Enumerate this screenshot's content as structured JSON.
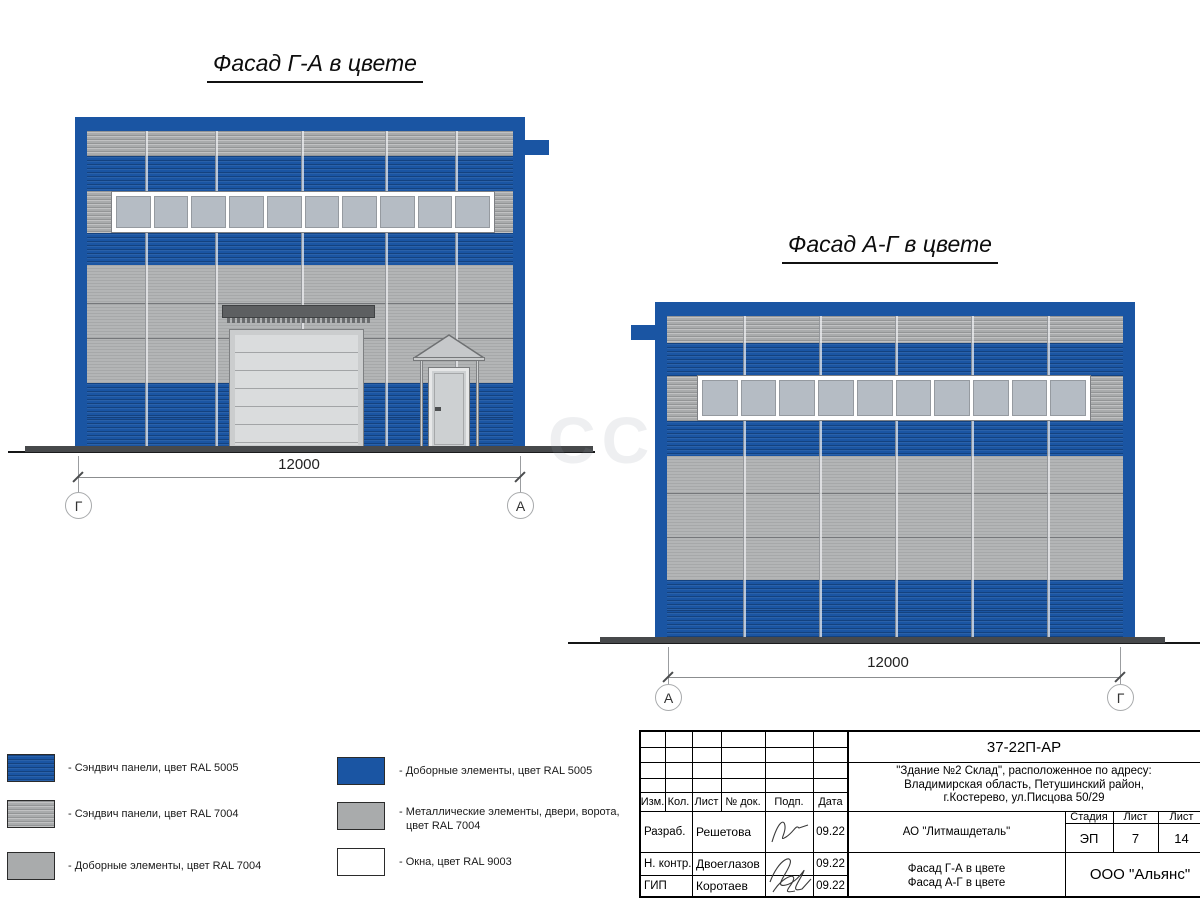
{
  "sheet": {
    "watermark": "СС"
  },
  "facade1": {
    "title": "Фасад Г-А в цвете",
    "dimension": "12000",
    "axis_left": "Г",
    "axis_right": "А",
    "window_panes": 10
  },
  "facade2": {
    "title": "Фасад А-Г в цвете",
    "dimension": "12000",
    "axis_left": "А",
    "axis_right": "Г",
    "window_panes": 10
  },
  "legend": {
    "left": [
      {
        "label": "- Сэндвич панели, цвет RAL 5005",
        "color": "#1a55a3"
      },
      {
        "label": "- Сэндвич панели, цвет RAL 7004",
        "color": "#a9abac"
      },
      {
        "label": "- Доборные элементы, цвет RAL 7004",
        "color": "#a9abac"
      }
    ],
    "right": [
      {
        "label": "- Доборные элементы, цвет RAL 5005",
        "color": "#1a55a3"
      },
      {
        "label_line1": "- Металлические элементы, двери, ворота,",
        "label_line2": "цвет RAL 7004",
        "color": "#a9abac"
      },
      {
        "label": "- Окна, цвет RAL 9003",
        "color": "#ffffff"
      }
    ]
  },
  "titleblock": {
    "doc_number": "37-22П-АР",
    "address_line1": "\"Здание №2 Склад\", расположенное по адресу:",
    "address_line2": "Владимирская область, Петушинский район,",
    "address_line3": "г.Костерево, ул.Писцова 50/29",
    "columns": [
      "Изм.",
      "Кол.",
      "Лист",
      "№ док.",
      "Подп.",
      "Дата"
    ],
    "rows": [
      {
        "role": "Разраб.",
        "name": "Решетова",
        "date": "09.22"
      },
      {
        "role": "Н. контр.",
        "name": "Двоеглазов",
        "date": "09.22"
      },
      {
        "role": "ГИП",
        "name": "Коротаев",
        "date": "09.22"
      }
    ],
    "company": "АО \"Литмашдеталь\"",
    "stage_header": [
      "Стадия",
      "Лист",
      "Лист"
    ],
    "stage": "ЭП",
    "sheet_number": "7",
    "sheet_total": "14",
    "drawing_title_line1": "Фасад Г-А в цвете",
    "drawing_title_line2": "Фасад А-Г в цвете",
    "org": "ООО \"Альянс\""
  },
  "colors": {
    "ral5005_blue": "#1a55a3",
    "ral7004_grey": "#a9abac",
    "ral9003_white": "#ffffff",
    "ground": "#47494b"
  }
}
